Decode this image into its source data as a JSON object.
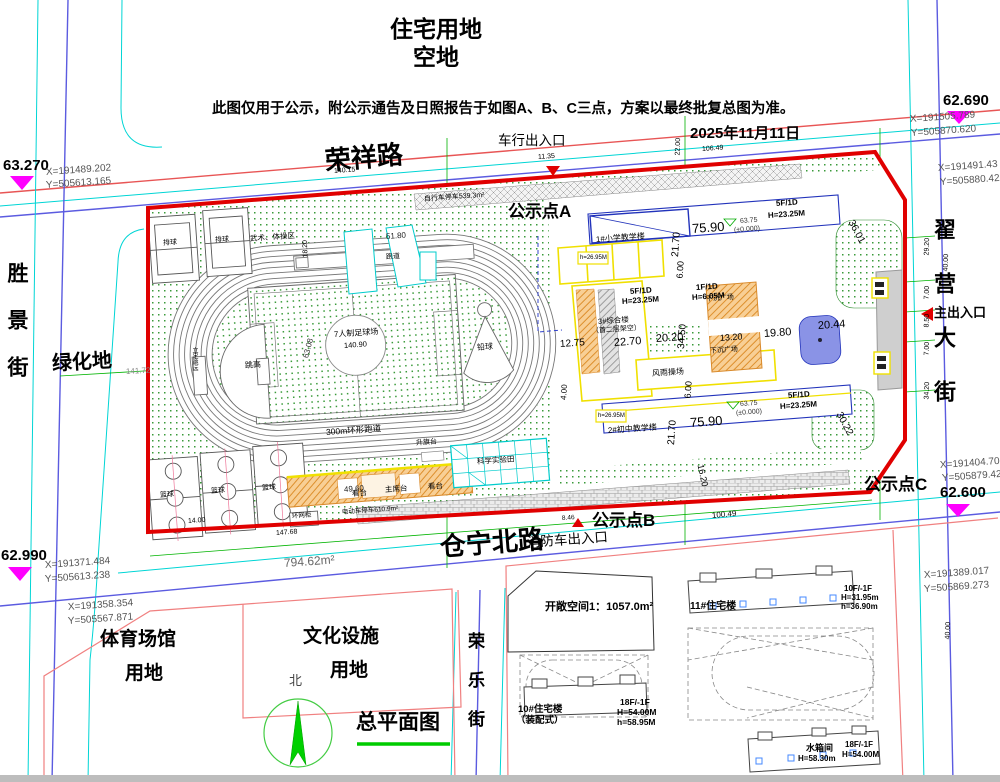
{
  "header": {
    "land_use_line1": "住宅用地",
    "land_use_line2": "空地",
    "notice": "此图仅用于公示，附公示通告及日照报告于如图A、B、C三点，方案以最终批复总图为准。",
    "date": "2025年11月11日"
  },
  "roads": {
    "rongxiang": "荣祥路",
    "cangning": "仓宁北路",
    "shengjing": "胜景街",
    "zhaiying": "翟营大街",
    "rongle": "荣乐街"
  },
  "entrances": {
    "vehicle": "车行出入口",
    "fire": "消防车出入口",
    "main": "主出入口"
  },
  "notice_points": {
    "a": "公示点A",
    "b": "公示点B",
    "c": "公示点C"
  },
  "elevations": {
    "nw": "63.270",
    "sw": "62.990",
    "ne": "62.690",
    "se": "62.600"
  },
  "coords": {
    "nw_x": "X=191489.202",
    "nw_y": "Y=505613.165",
    "ne1_x": "X=191505.789",
    "ne1_y": "Y=505870.620",
    "ne2_x": "X=191491.43",
    "ne2_y": "Y=505880.42",
    "se1_x": "X=191404.70",
    "se1_y": "Y=505879.42",
    "se2_x": "X=191389.017",
    "se2_y": "Y=505869.273",
    "sw1_x": "X=191371.484",
    "sw1_y": "Y=505613.238",
    "sw2_x": "X=191358.354",
    "sw2_y": "Y=505567.871"
  },
  "parcels": {
    "green_land": "绿化地",
    "sports_line1": "体育场馆",
    "sports_line2": "用地",
    "culture_line1": "文化设施",
    "culture_line2": "用地"
  },
  "sports": {
    "volleyball": "排球",
    "martial_zone": "武术、体操区",
    "runway": "跑道",
    "football": "7人制足球场",
    "track": "300m环形跑道",
    "high_jump": "跳高",
    "standing_jump": "立定跳远",
    "shot_put": "铅球",
    "stand": "看台",
    "rostrum": "主席台",
    "flag_platform": "升旗台",
    "science_field": "科学实验田",
    "basketball": "篮球"
  },
  "facilities": {
    "bike_parking": "自行车停车539.3m²",
    "ebike_parking": "电动车停车610.9m²",
    "ring_cabinet": "环网柜",
    "boundary_area": "794.62m²",
    "open_space": "开敞空间1：1057.0m²"
  },
  "buildings": {
    "b1": "1#小学教学楼",
    "b2": "2#初中教学楼",
    "b3_line1": "3#综合楼",
    "b3_line2": "（首二层架空）",
    "gym": "风雨操场",
    "sunken_plaza": "下沉广场",
    "spec_5f": "5F/1D",
    "spec_h": "H=23.25M",
    "spec_1f": "1F/1D",
    "spec_1f_h": "H=6.05M",
    "roof_h": "h=26.95M",
    "level": "63.75",
    "level_zero": "(±0.000)"
  },
  "residential": {
    "b11": "11#住宅楼",
    "b11_f": "10F/-1F",
    "b11_h": "H=31.95m",
    "b11_h2": "h=36.90m",
    "b10_line1": "10#住宅楼",
    "b10_line2": "（装配式）",
    "b10_f": "18F/-1F",
    "b10_h": "H=54.00M",
    "b10_h2": "h=58.95M",
    "tank": "水箱间",
    "tank_h": "H=58.30m",
    "tank_f": "18F/-1F",
    "tank_fh": "H=54.00M"
  },
  "dims": {
    "d140_15": "140.15",
    "d11_35": "11.35",
    "d22_00": "22.00",
    "d106_49": "106.49",
    "d51_80": "51.80",
    "d18_20": "18.20",
    "d141_72": "141.72",
    "d63_08": "63.08",
    "d140_90": "140.90",
    "d75_90": "75.90",
    "d21_70": "21.70",
    "d6_00": "6.00",
    "d22_70": "22.70",
    "d20_20": "20.20",
    "d34_50": "34.50",
    "d13_20": "13.20",
    "d19_80": "19.80",
    "d20_44": "20.44",
    "d12_75": "12.75",
    "d4_00": "4.00",
    "d36_01": "36.01",
    "d30_22": "30.22",
    "d16_20": "16.20",
    "d100_49": "100.49",
    "d8_46": "8.46",
    "d49_60": "49.60",
    "d14_00": "14.00",
    "d147_68": "147.68",
    "d29_20": "29.20",
    "d7_00": "7.00",
    "d8_50": "8.50",
    "d34_20": "34.20",
    "d40_00": "40.00"
  },
  "titles": {
    "north": "北",
    "plan": "总平面图"
  }
}
